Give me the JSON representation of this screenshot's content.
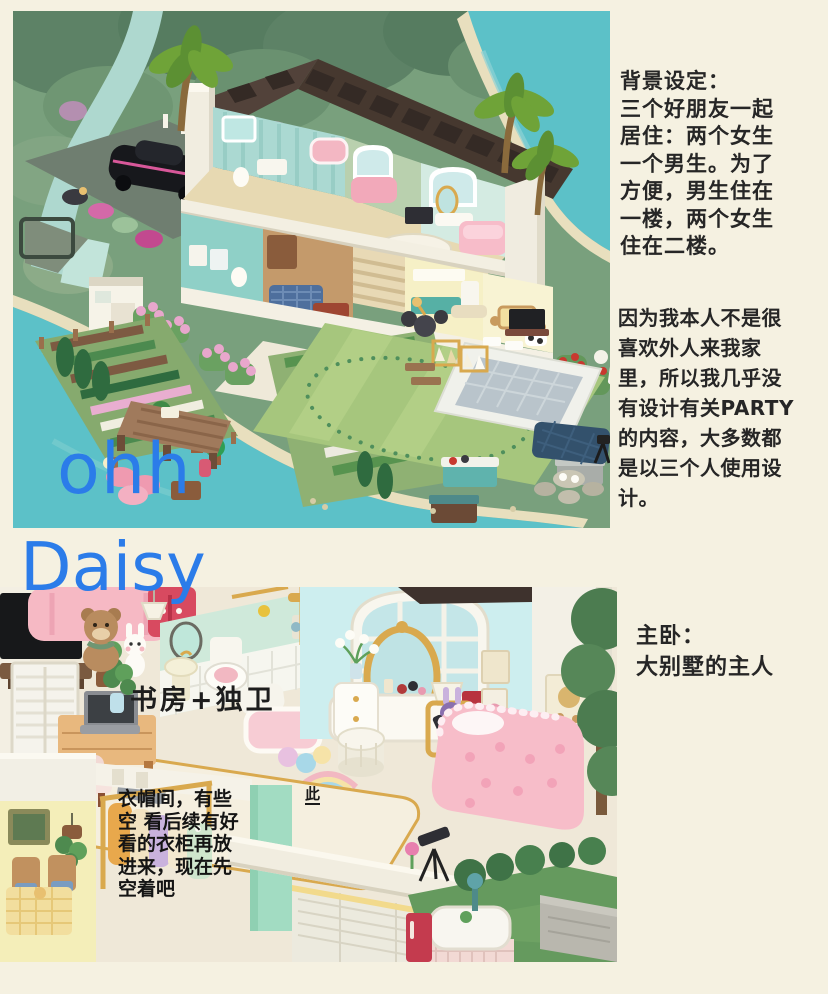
{
  "page": {
    "canvas_color": "#f5f1e1",
    "ink_color": "#262626",
    "accent_blue": "#2b7ce9"
  },
  "watermark": {
    "line1": "ohh",
    "line2": "Daisy",
    "logo": "此"
  },
  "notes": {
    "background_setting": "背景设定：\n三个好朋友一起\n居住：两个女生\n一个男生。为了\n方便，男生住在\n一楼，两个女生\n住在二楼。",
    "party_note": "因为我本人不是很\n喜欢外人来我家\n里，所以我几乎没\n有设计有关PARTY\n的内容，大多数都\n是以三个人使用设\n计。",
    "master_bedroom": "主卧：\n大别墅的主人",
    "study_label": "书房+独卫",
    "cloakroom_note": "衣帽间，有些\n空 看后续有好\n看的衣柜再放\n进来，现在先\n空着吧"
  },
  "scene_colors": {
    "water_teal": "#5cc1c8",
    "lawn_green": "#a6c67d",
    "roof_brown": "#46382f",
    "wall_cream": "#f2eee1",
    "bed_pink": "#f7bdc9",
    "bedroom_wall_blue": "#cdeeef",
    "bathroom_mint": "#cfe9da"
  }
}
